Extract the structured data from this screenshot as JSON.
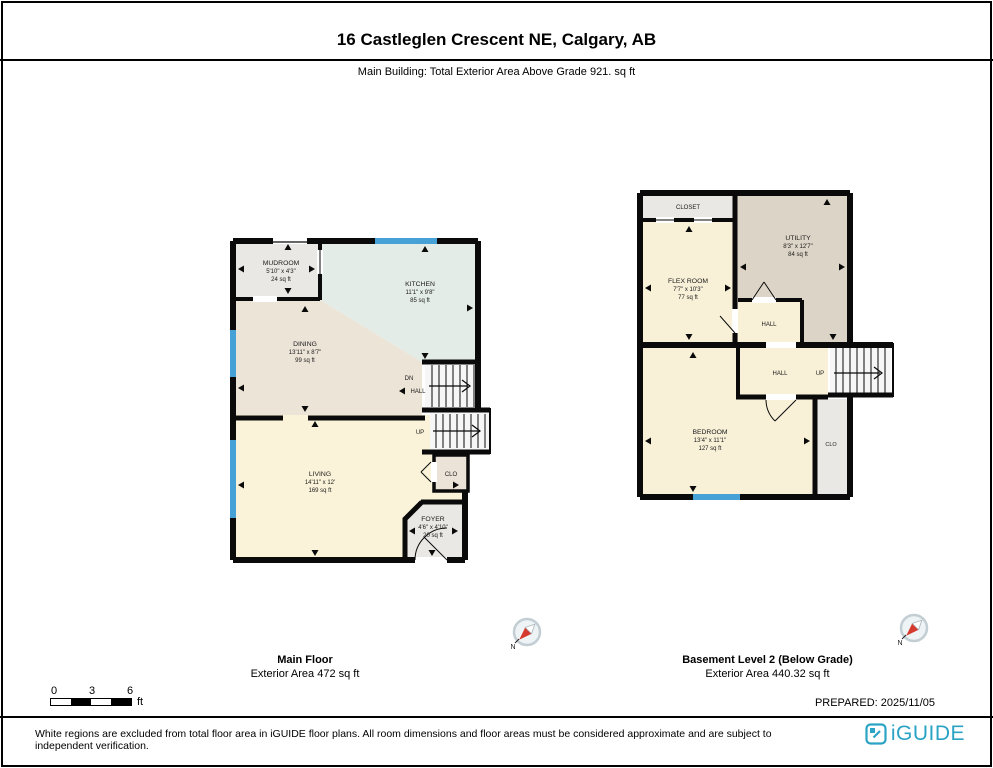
{
  "header": {
    "title": "16 Castleglen Crescent NE, Calgary, AB",
    "subtitle": "Main Building: Total Exterior Area Above Grade 921. sq ft"
  },
  "main_floor": {
    "caption_title": "Main Floor",
    "caption_area": "Exterior Area 472 sq ft",
    "rooms": {
      "mudroom": {
        "name": "MUDROOM",
        "dims": "5'10\" x 4'3\"",
        "area": "24 sq ft"
      },
      "kitchen": {
        "name": "KITCHEN",
        "dims": "11'1\" x 9'8\"",
        "area": "85 sq ft"
      },
      "dining": {
        "name": "DINING",
        "dims": "13'11\" x 8'7\"",
        "area": "99 sq ft"
      },
      "living": {
        "name": "LIVING",
        "dims": "14'11\" x 12'",
        "area": "169 sq ft"
      },
      "foyer": {
        "name": "FOYER",
        "dims": "4'6\" x 4'10\"",
        "area": "20 sq ft"
      },
      "closet": {
        "name": "CLO"
      }
    },
    "stairs": {
      "dn": "DN",
      "hall": "HALL",
      "up": "UP"
    }
  },
  "basement": {
    "caption_title": "Basement Level 2 (Below Grade)",
    "caption_area": "Exterior Area 440.32 sq ft",
    "rooms": {
      "closet_top": {
        "name": "CLOSET"
      },
      "flex": {
        "name": "FLEX ROOM",
        "dims": "7'7\" x 10'3\"",
        "area": "77 sq ft"
      },
      "utility": {
        "name": "UTILITY",
        "dims": "8'3\" x 12'7\"",
        "area": "84 sq ft"
      },
      "hall_inner": {
        "name": "HALL"
      },
      "hall_lower": {
        "name": "HALL"
      },
      "bedroom": {
        "name": "BEDROOM",
        "dims": "13'4\" x 11'1\"",
        "area": "127 sq ft"
      },
      "closet_side": {
        "name": "CLO"
      }
    },
    "stairs": {
      "up": "UP"
    }
  },
  "compass": {
    "north_label": "N"
  },
  "scale_bar": {
    "ticks": [
      "0",
      "3",
      "6"
    ],
    "unit": "ft"
  },
  "prepared": "PREPARED: 2025/11/05",
  "footer": {
    "disclaimer": "White regions are excluded from total floor area in iGUIDE floor plans. All room dimensions and floor areas must be considered approximate and are subject to independent verification.",
    "brand": "iGUIDE"
  },
  "colors": {
    "wall": "#0a0a0a",
    "room_yellow": "#faf3d9",
    "room_beige": "#ede4d8",
    "room_gray": "#e9e8e4",
    "room_green": "#e4ece8",
    "room_taupe": "#dcd4c6",
    "window_blue": "#45a1d6",
    "brand_teal": "#2ba3c4"
  }
}
